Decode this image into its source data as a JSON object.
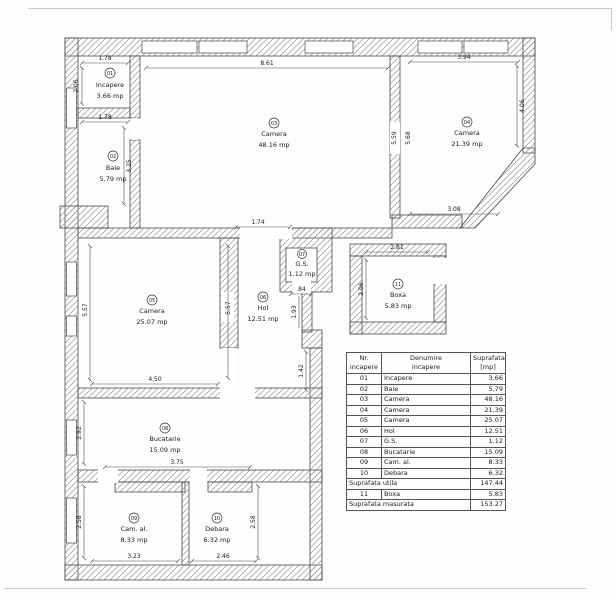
{
  "plan": {
    "rooms": [
      {
        "id": "01",
        "name": "Incapere",
        "area": "3.66 mp"
      },
      {
        "id": "02",
        "name": "Baie",
        "area": "5.79 mp"
      },
      {
        "id": "03",
        "name": "Camera",
        "area": "48.16 mp"
      },
      {
        "id": "04",
        "name": "Camera",
        "area": "21.39 mp"
      },
      {
        "id": "05",
        "name": "Camera",
        "area": "25.07 mp"
      },
      {
        "id": "06",
        "name": "Hol",
        "area": "12.51 mp"
      },
      {
        "id": "07",
        "name": "G.S.",
        "area": "1.12 mp"
      },
      {
        "id": "08",
        "name": "Bucatarie",
        "area": "15.09 mp"
      },
      {
        "id": "09",
        "name": "Cam. al.",
        "area": "8.33 mp"
      },
      {
        "id": "10",
        "name": "Debara",
        "area": "6.32 mp"
      },
      {
        "id": "11",
        "name": "Boxa",
        "area": "5.83 mp"
      }
    ],
    "dims": {
      "incapere_top": "1.78",
      "incapere_left": "2.06",
      "baie_top": "1.78",
      "baie_right": "3.25",
      "camera03_top": "8.61",
      "camera04_top": "3.94",
      "camera04_right": "4.06",
      "camera04_bottom": "3.08",
      "wall34_left": "5.59",
      "wall34_right": "5.68",
      "hol_top": "1.74",
      "gs_bottom": ".84",
      "gs_wall_height": "1.93",
      "hol_lower": "1.42",
      "camera05_bottom": "4.50",
      "camera05_left": "5.57",
      "camera05_right": "5.57",
      "boxa_top": "2.81",
      "boxa_left": "2.06",
      "bucatarie_left": "2.92",
      "bucatarie_bottom": "3.75",
      "cam_al_bottom": "3.23",
      "cam_al_left": "2.58",
      "debara_bottom": "2.46",
      "debara_right": "2.58"
    }
  },
  "table": {
    "headers": {
      "nr": "Nr.\nincapere",
      "name": "Denumire\nincapere",
      "area": "Suprafata\n[mp]"
    },
    "rows": [
      {
        "nr": "01",
        "name": "Incapere",
        "area": "3.66"
      },
      {
        "nr": "02",
        "name": "Baie",
        "area": "5.79"
      },
      {
        "nr": "03",
        "name": "Camera",
        "area": "48.16"
      },
      {
        "nr": "04",
        "name": "Camera",
        "area": "21.39"
      },
      {
        "nr": "05",
        "name": "Camera",
        "area": "25.07"
      },
      {
        "nr": "06",
        "name": "Hol",
        "area": "12.51"
      },
      {
        "nr": "07",
        "name": "G.S.",
        "area": "1.12"
      },
      {
        "nr": "08",
        "name": "Bucatarie",
        "area": "15.09"
      },
      {
        "nr": "09",
        "name": "Cam. al.",
        "area": "8.33"
      },
      {
        "nr": "10",
        "name": "Debara",
        "area": "6.32"
      }
    ],
    "totals": {
      "utila_label": "Suprafata utila",
      "utila_value": "147.44",
      "boxa_nr": "11",
      "boxa_name": "Boxa",
      "boxa_area": "5.83",
      "masurata_label": "Suprafata masurata",
      "masurata_value": "153.27"
    }
  }
}
